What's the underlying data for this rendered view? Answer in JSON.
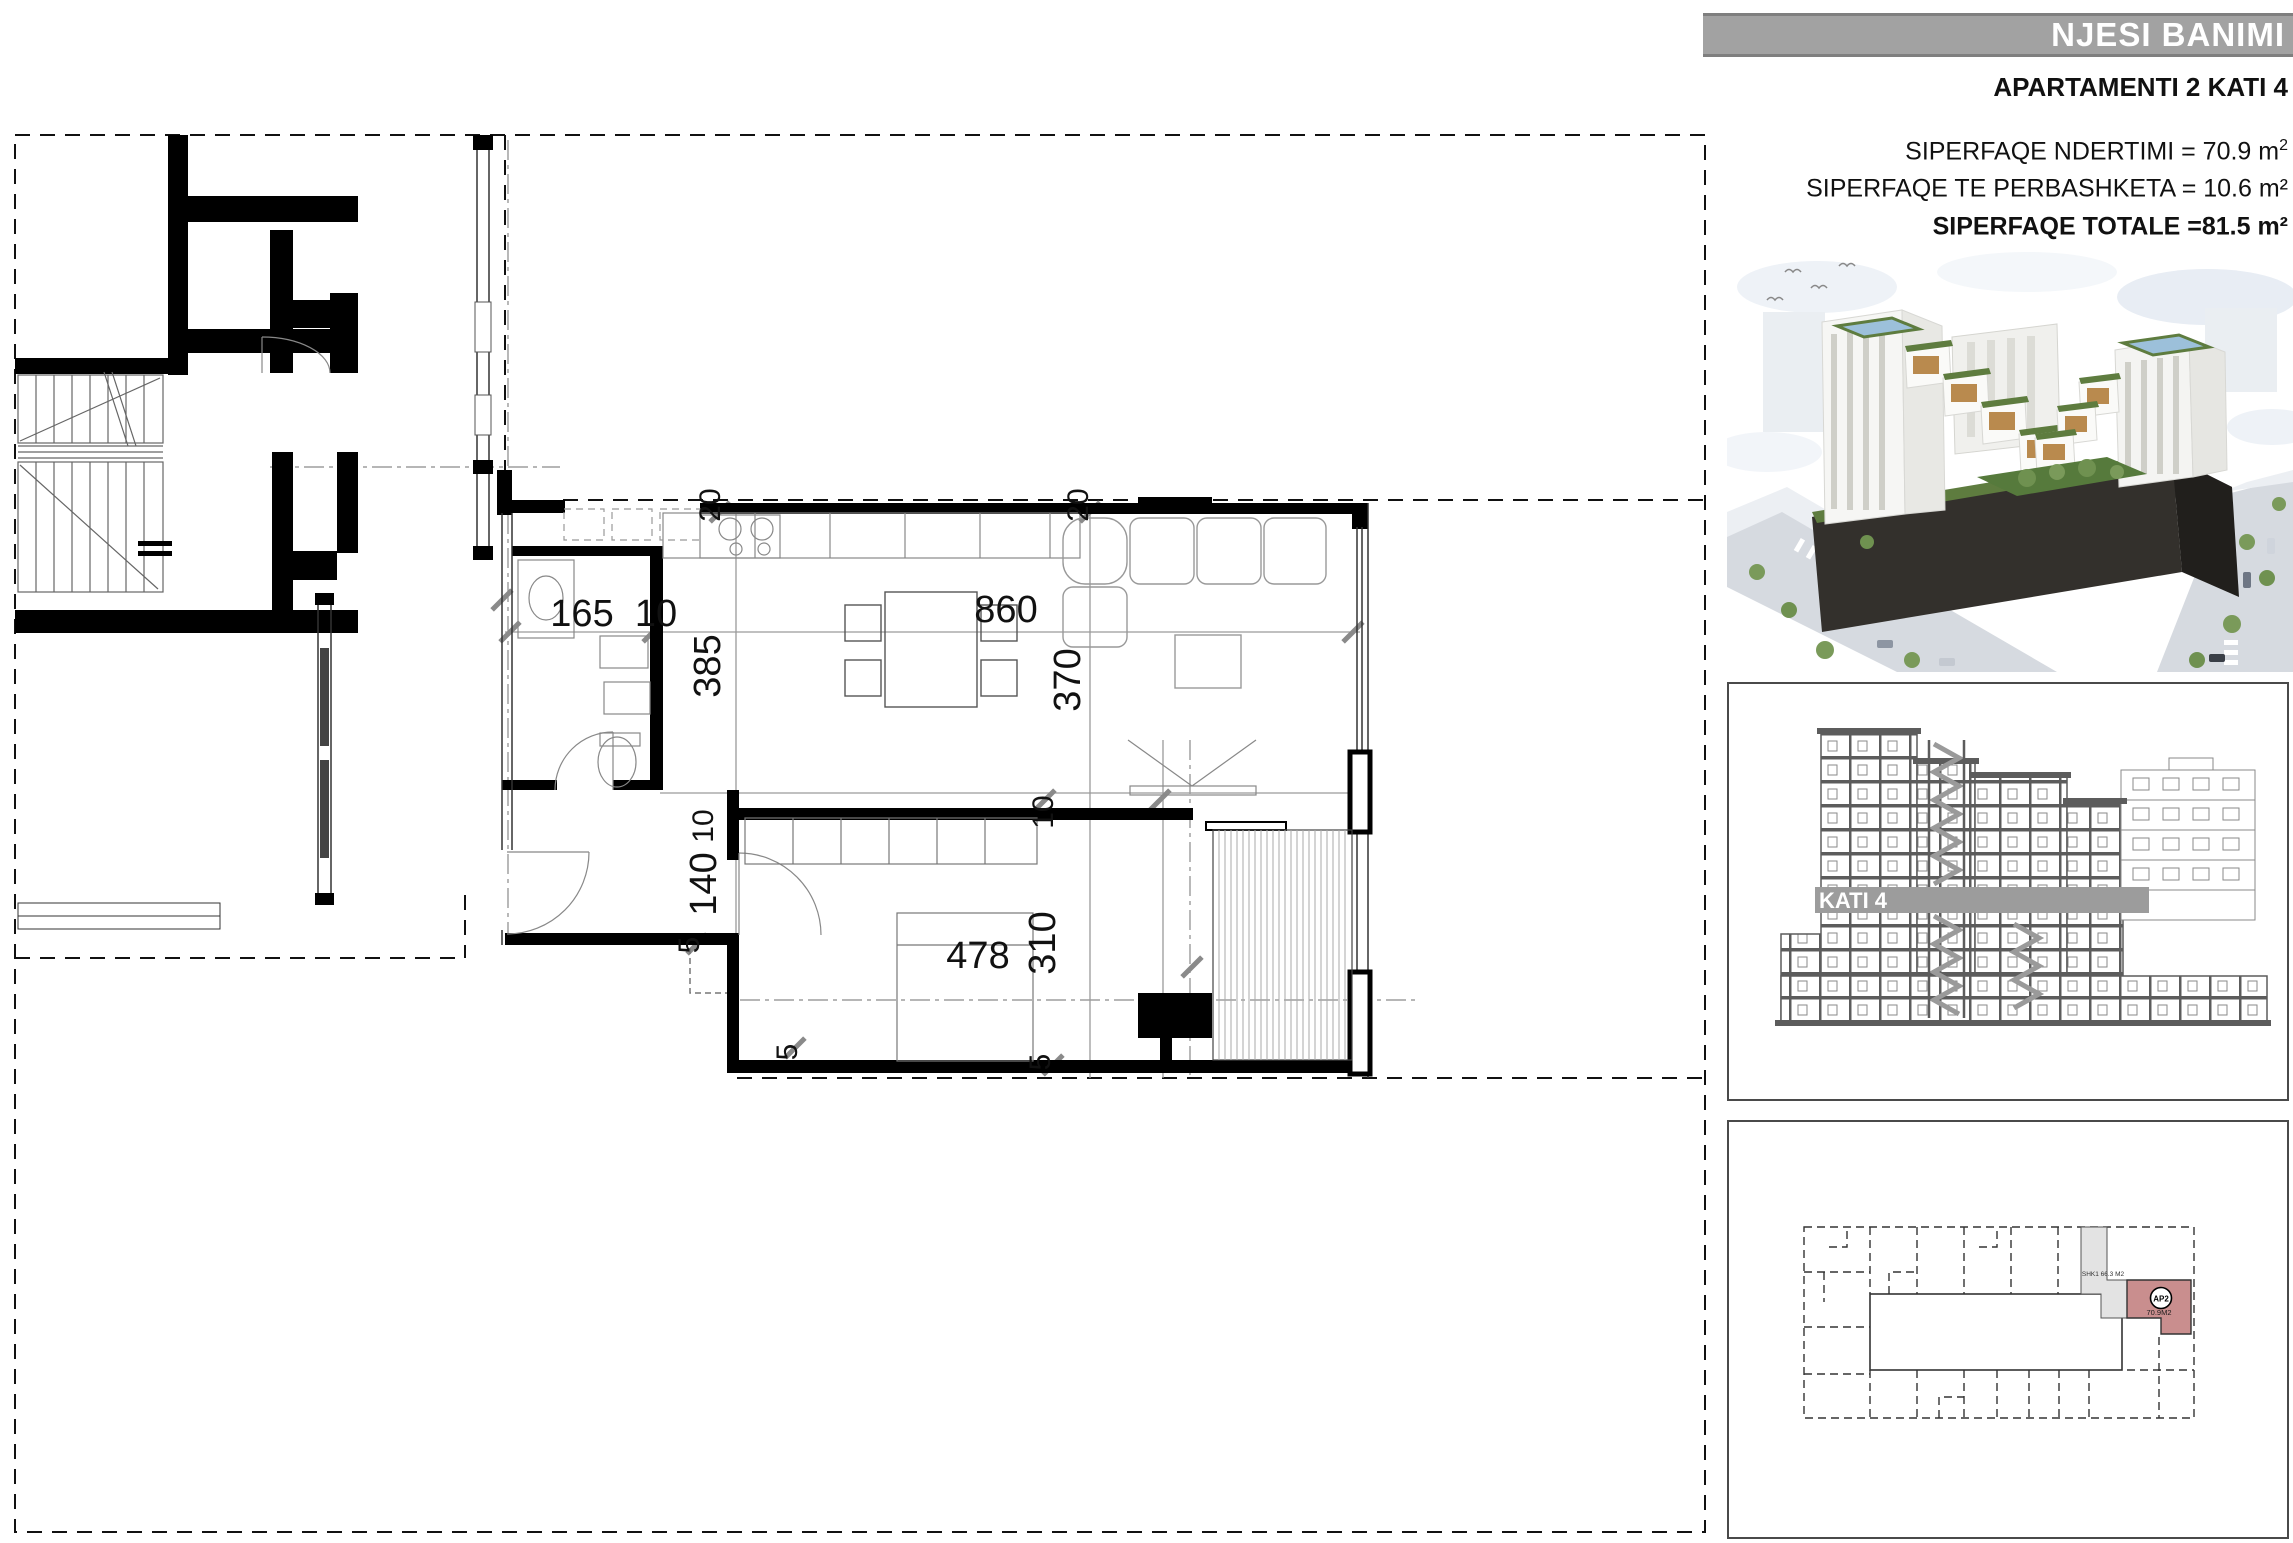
{
  "panel": {
    "title": "NJESI BANIMI",
    "subtitle": "APARTAMENTI 2 KATI 4",
    "area_lines": [
      {
        "text": "SIPERFAQE NDERTIMI = 70.9 m",
        "sup": "2"
      },
      {
        "text": "SIPERFAQE TE PERBASHKETA = 10.6 m²",
        "sup": ""
      },
      {
        "text": "SIPERFAQE TOTALE =81.5 m²",
        "sup": ""
      }
    ],
    "section": {
      "floor_label": "KATI 4"
    },
    "key_plan": {
      "unit_label": "AP2",
      "unit_area": "70.9M2",
      "common_label": "SHK1 66.3 M2"
    }
  },
  "plan": {
    "dimensions": [
      {
        "v": "165",
        "x": 582,
        "y": 626,
        "rot": 0,
        "s": 38
      },
      {
        "v": "10",
        "x": 656,
        "y": 626,
        "rot": 0,
        "s": 38
      },
      {
        "v": "860",
        "x": 1006,
        "y": 622,
        "rot": 0,
        "s": 38
      },
      {
        "v": "385",
        "x": 720,
        "y": 666,
        "rot": -90,
        "s": 38
      },
      {
        "v": "370",
        "x": 1080,
        "y": 680,
        "rot": -90,
        "s": 38
      },
      {
        "v": "140",
        "x": 716,
        "y": 884,
        "rot": -90,
        "s": 38
      },
      {
        "v": "478",
        "x": 978,
        "y": 968,
        "rot": 0,
        "s": 38
      },
      {
        "v": "310",
        "x": 1055,
        "y": 943,
        "rot": -90,
        "s": 38
      },
      {
        "v": "10",
        "x": 713,
        "y": 826,
        "rot": -90,
        "s": 30
      },
      {
        "v": "10",
        "x": 1053,
        "y": 812,
        "rot": -90,
        "s": 30
      },
      {
        "v": "20",
        "x": 720,
        "y": 505,
        "rot": -90,
        "s": 30
      },
      {
        "v": "20",
        "x": 1088,
        "y": 505,
        "rot": -90,
        "s": 30
      },
      {
        "v": "5",
        "x": 699,
        "y": 945,
        "rot": -90,
        "s": 30
      },
      {
        "v": "5",
        "x": 797,
        "y": 1052,
        "rot": -90,
        "s": 30
      },
      {
        "v": "5",
        "x": 1050,
        "y": 1062,
        "rot": -90,
        "s": 30
      }
    ]
  },
  "colors": {
    "header_gray": "#a2a2a2",
    "section_gray": "#5c5c5c",
    "band_gray": "#9c9c9c",
    "unit_red": "#c98e8e",
    "common_gray": "#e3e3e3"
  }
}
